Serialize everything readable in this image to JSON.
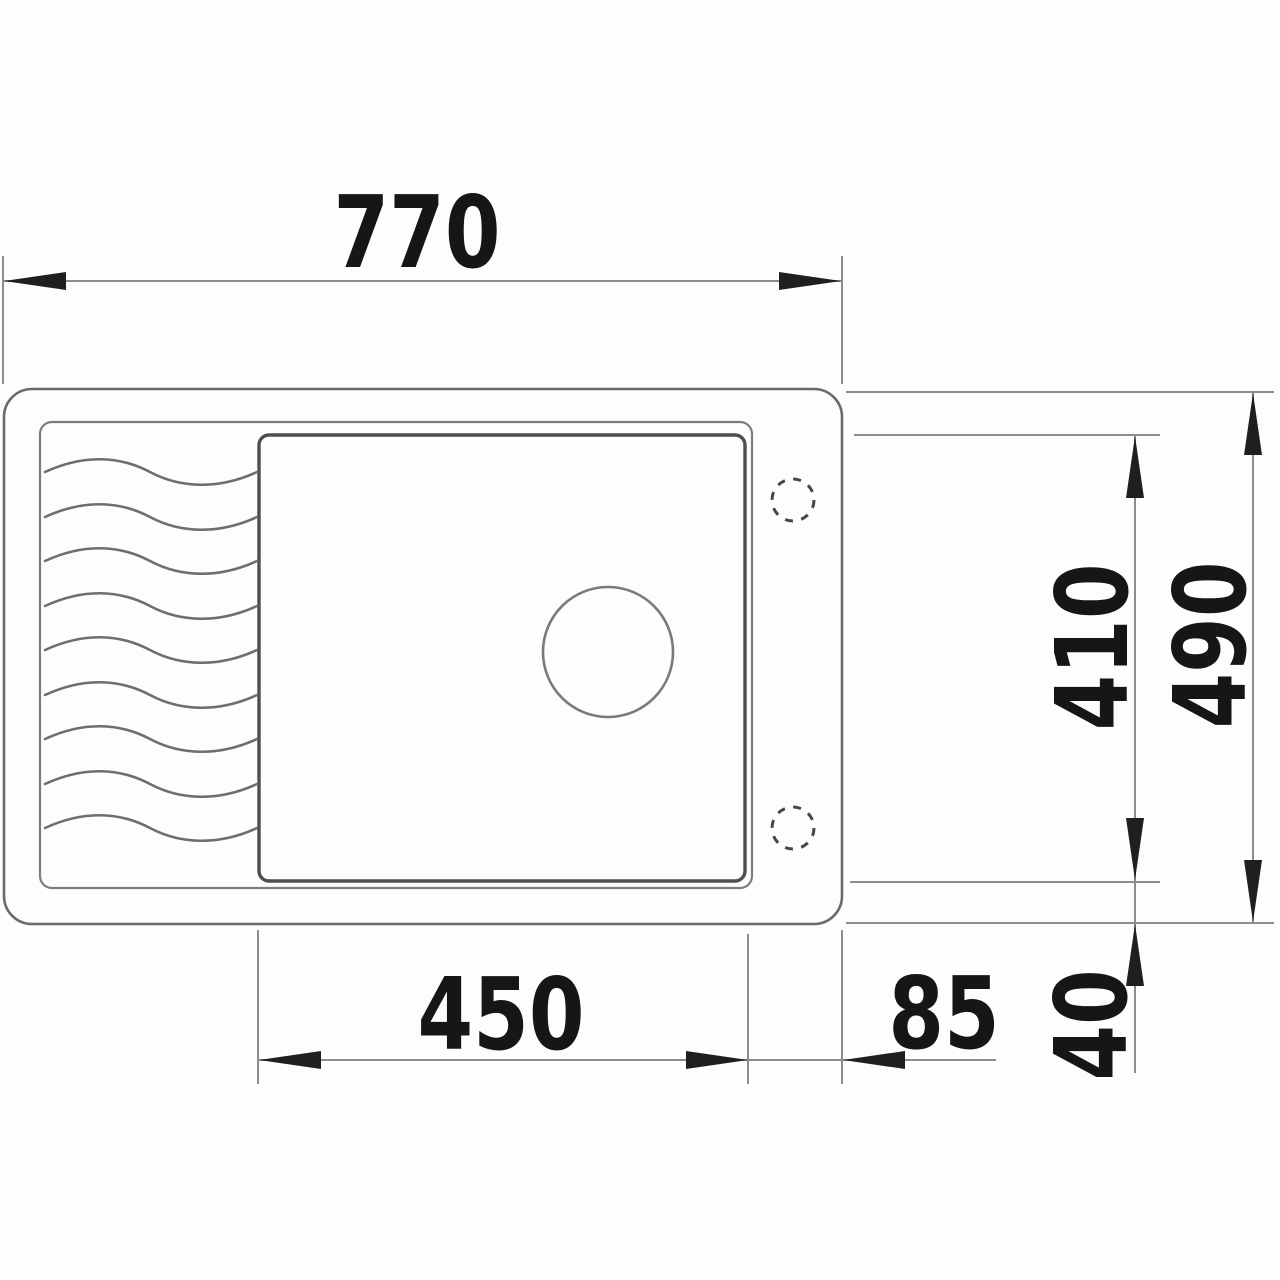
{
  "drawing": {
    "title": "sink-top-view-dimension-drawing",
    "labels": {
      "overall_width": "770",
      "overall_depth": "490",
      "bowl_depth": "410",
      "bowl_width": "450",
      "tap_ledge_width": "85",
      "rim_offset": "40"
    },
    "colors": {
      "background": "#fdfdfd",
      "outline_line": "#6b6b6b",
      "basin_line": "#4e4e4e",
      "dimension_line": "#8d8d8d",
      "arrow_and_text": "#1f1f1f"
    }
  }
}
